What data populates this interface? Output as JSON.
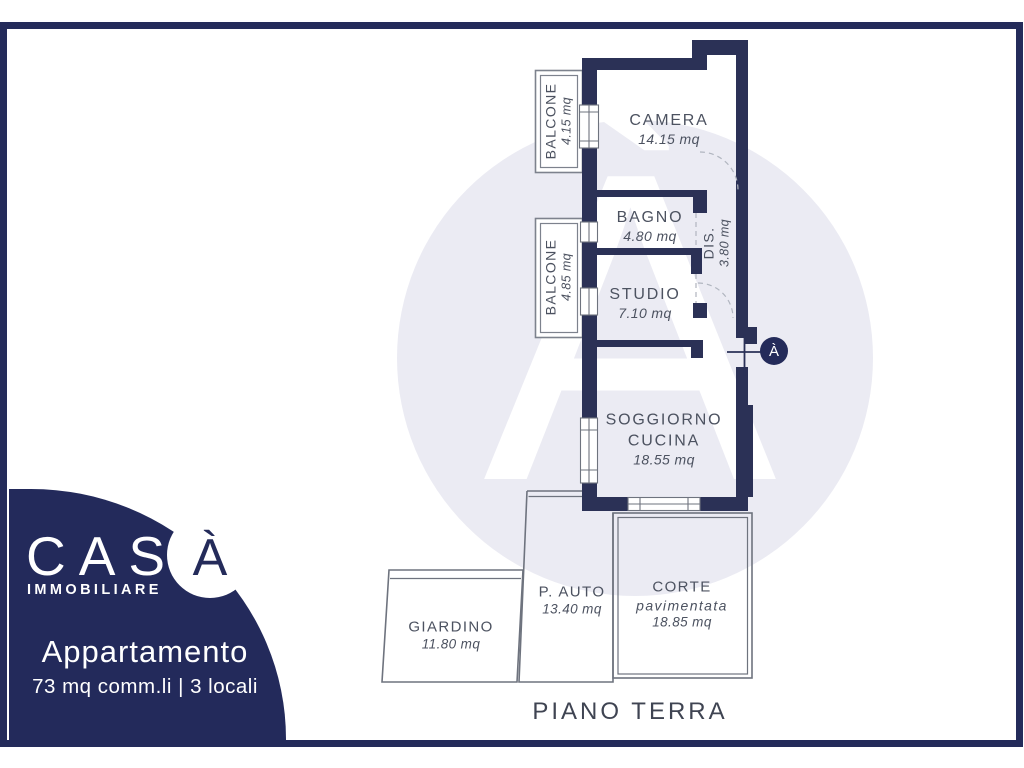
{
  "brand": {
    "name": "CAS",
    "accent_letter": "À",
    "tagline": "IMMOBILIARE"
  },
  "listing": {
    "title": "Appartamento",
    "specs": "73 mq comm.li | 3 locali"
  },
  "plan": {
    "floor_label": "PIANO TERRA",
    "north_marker_letter": "À",
    "watermark_letter": "À"
  },
  "colors": {
    "wall_navy": "#2b3156",
    "brand_navy": "#242b5a",
    "watermark_lavender": "#ebebf3",
    "label_gray": "#4c5260",
    "outline_gray": "#6e737e"
  },
  "rooms": {
    "camera": {
      "name": "CAMERA",
      "area": "14.15 mq"
    },
    "bagno": {
      "name": "BAGNO",
      "area": "4.80 mq"
    },
    "studio": {
      "name": "STUDIO",
      "area": "7.10 mq"
    },
    "dis": {
      "name": "DIS.",
      "area": "3.80 mq"
    },
    "soggiorno": {
      "line1": "SOGGIORNO",
      "line2": "CUCINA",
      "area": "18.55 mq"
    },
    "balcone_top": {
      "name": "BALCONE",
      "area": "4.15 mq"
    },
    "balcone_bottom": {
      "name": "BALCONE",
      "area": "4.85 mq"
    },
    "giardino": {
      "name": "GIARDINO",
      "area": "11.80 mq"
    },
    "posto_auto": {
      "name": "P. AUTO",
      "area": "13.40 mq"
    },
    "corte": {
      "line1": "CORTE",
      "line2": "pavimentata",
      "area": "18.85 mq"
    }
  }
}
